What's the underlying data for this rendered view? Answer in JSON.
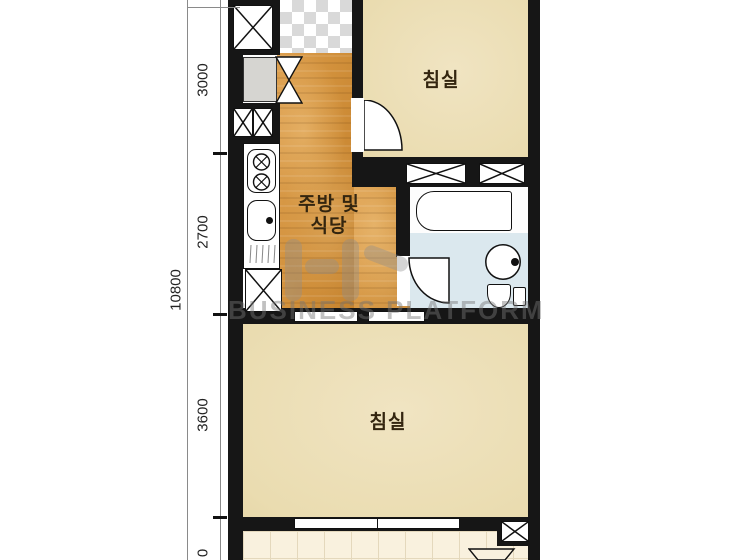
{
  "plan": {
    "rooms": {
      "bedroom_top": {
        "label": "침실"
      },
      "kitchen": {
        "label_line1": "주방 및",
        "label_line2": "식당"
      },
      "bedroom_bottom": {
        "label": "침실"
      }
    },
    "dimensions": {
      "total": "10800",
      "seg_top": "3000",
      "seg_mid": "2700",
      "seg_low": "3600",
      "seg_bottom_visible": "0"
    },
    "fixtures": [
      "shaft-x-box",
      "shoe-cabinet",
      "entrance-door-mark",
      "gas-stove",
      "kitchen-sink",
      "closet-x-box",
      "bathtub",
      "washbasin",
      "toilet",
      "door-swing",
      "window",
      "balcony-shaft",
      "vent-trapezoid"
    ],
    "colors": {
      "wall": "#161616",
      "kitchen_floor": "#D2913C",
      "bedroom_floor": "#EADCB0",
      "bathroom_floor": "#DBE8EE",
      "balcony_floor": "#F9F1DE",
      "entrance_checker": "#D9D9D9",
      "watermark": "#8D8D8D"
    }
  },
  "watermark": {
    "text": "BUSINESS PLATFORM"
  }
}
